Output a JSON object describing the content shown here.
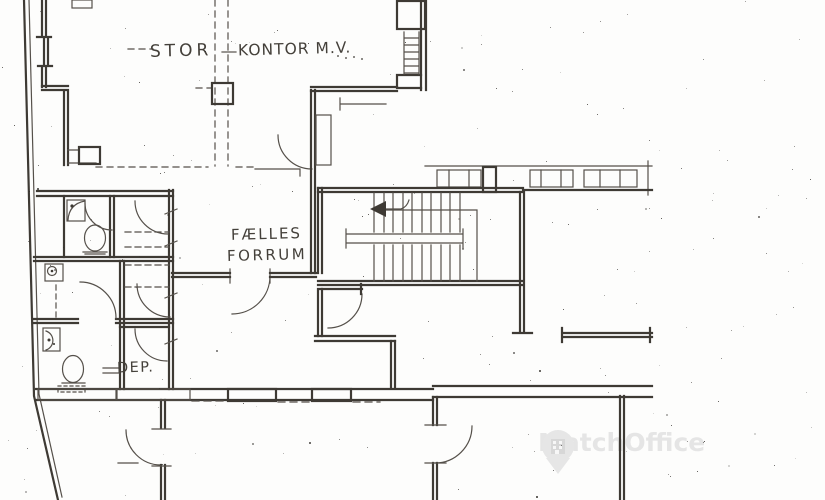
{
  "plan": {
    "rooms": [
      {
        "id": "stor-kontor",
        "label_part1": "STOR",
        "label_part2": "KONTOR M.V."
      },
      {
        "id": "faelles-forrum",
        "label_line1": "FÆLLES",
        "label_line2": "FORRUM"
      },
      {
        "id": "dep",
        "label": "DEP."
      }
    ]
  },
  "watermark": {
    "text": "MatchOffice",
    "icon": "location-pin-building-icon"
  },
  "colors": {
    "ink": "#3e3a34",
    "ink_light": "#55504a",
    "paper": "#fdfdfc",
    "watermark_gray": "#e5e5e5"
  }
}
